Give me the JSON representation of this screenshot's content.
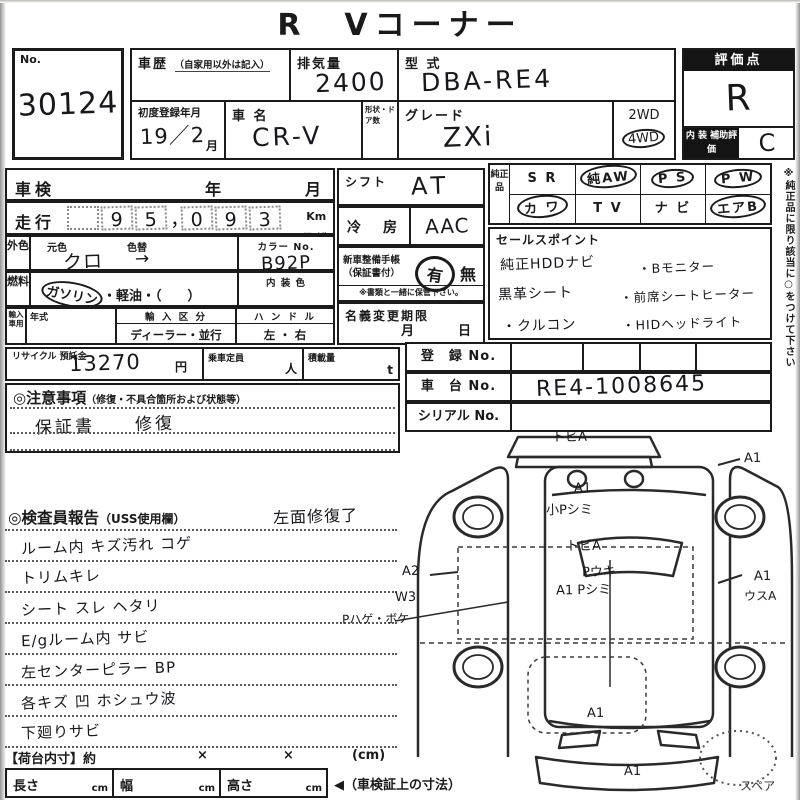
{
  "title": "R　Vコーナー",
  "lot_no": {
    "label": "No.",
    "value": "30124"
  },
  "history": {
    "label": "車歴",
    "note": "（自家用以外は記入）",
    "value": ""
  },
  "displacement": {
    "label": "排気量",
    "value": "2400"
  },
  "model_code": {
    "label": "型 式",
    "value": "DBA-RE4"
  },
  "first_registration": {
    "label": "初度登録年月",
    "value": "19／2",
    "suffix": "月"
  },
  "car_name": {
    "label": "車 名",
    "value": "CR-V"
  },
  "body_doors": {
    "label": "形状・ドア数",
    "value": ""
  },
  "grade": {
    "label": "グレード",
    "value": "ZXi"
  },
  "drivetrain": {
    "options": [
      "2WD",
      "4WD"
    ],
    "selected": "4WD"
  },
  "rating": {
    "header": "評価点",
    "value": "R",
    "interior_label": "内 装 補助評価",
    "interior_value": "C"
  },
  "shaken": {
    "label": "車検",
    "year_label": "年",
    "month_label": "月",
    "value": ""
  },
  "odometer": {
    "label": "走行",
    "digits": [
      "9",
      "5",
      "0",
      "9",
      "3"
    ],
    "comma": "，",
    "unit_km": "Km",
    "unit_mile": "マイル",
    "value": "95,093"
  },
  "exterior_color": {
    "label": "外色",
    "base_label": "元色",
    "base_value": "クロ",
    "change_label": "色替",
    "change_value": "→",
    "color_no_label": "カラー No.",
    "color_no_value": "B92P"
  },
  "fuel": {
    "label": "燃料",
    "gasoline": "ガソリン",
    "rest": "・軽油・（　　）",
    "selected": "ガソリン",
    "interior_color_label": "内 装 色",
    "interior_color_value": ""
  },
  "import_info": {
    "label": "輸入車用",
    "year_label": "年式",
    "division_label": "輸 入 区 分",
    "division_value": "ディーラー・並行",
    "handle_label": "ハ ン ド ル",
    "handle_value": "左 ・ 右"
  },
  "recycle": {
    "label": "リサイクル 預託金",
    "value": "13270",
    "unit": "円",
    "capacity_label": "乗車定員",
    "capacity_unit": "人",
    "load_label": "積載量",
    "load_unit": "t"
  },
  "cautions": {
    "header": "◎注意事項",
    "header_note": "（修復・不具合箇所および状態等）",
    "line1": "保証書　　修復"
  },
  "shift": {
    "label": "シフト",
    "value": "AT"
  },
  "aircon": {
    "label": "冷　房",
    "value": "AAC"
  },
  "service_book": {
    "label_line1": "新車整備手帳",
    "label_line2": "（保証書付）",
    "yes": "有",
    "no": "無",
    "selected": "有",
    "note": "※書類と一緒に保管下さい。"
  },
  "name_change": {
    "header": "名義変更期限",
    "month_label": "月",
    "day_label": "日"
  },
  "genuine": {
    "label": "純正品",
    "cells": [
      {
        "label": "S R",
        "circled": false
      },
      {
        "label": "純AW",
        "circled": true
      },
      {
        "label": "P S",
        "circled": true
      },
      {
        "label": "P W",
        "circled": true
      },
      {
        "label": "カ ワ",
        "circled": true
      },
      {
        "label": "T V",
        "circled": false
      },
      {
        "label": "ナ ビ",
        "circled": false
      },
      {
        "label": "エアB",
        "circled": true
      }
    ],
    "note_vertical": "※純正品に限り該当に○をつけて下さい"
  },
  "sales_points": {
    "header": "セールスポイント",
    "rows": [
      [
        "純正HDDナビ",
        "・Bモニター"
      ],
      [
        "黒革シート",
        "・前席シートヒーター"
      ],
      [
        "・クルコン",
        "・HIDヘッドライト"
      ]
    ]
  },
  "registration": {
    "reg_label": "登　録 No.",
    "reg_value": "",
    "chassis_label": "車　台 No.",
    "chassis_value": "RE4-1008645",
    "serial_label": "シリアル No.",
    "serial_value": ""
  },
  "inspector": {
    "header": "◎検査員報告",
    "header_note": "（USS使用欄）",
    "side_note": "左面修復了",
    "lines": [
      "ルーム内 キズ汚れ コゲ",
      "トリムキレ",
      "シート スレ ヘタリ",
      "E/gルーム内 サビ",
      "左センターピラー BP",
      "各キズ 凹 ホシュウ波",
      "下廻りサビ"
    ]
  },
  "cargo": {
    "header": "【荷台内寸】約",
    "x1": "×",
    "x2": "×",
    "unit": "(cm)",
    "length_label": "長さ",
    "width_label": "幅",
    "height_label": "高さ",
    "cm": "cm",
    "arrow_note": "◀（車検証上の寸法）"
  },
  "diagram": {
    "labels": {
      "top_tobi": "トビA",
      "roof_a1": "A1",
      "roof_shimi": "小Pシミ",
      "mid_tobi": "トビA",
      "p_uki": "Pウキ",
      "a1_pshimi": "A1 Pシミ",
      "left_a2": "A2",
      "left_w3": "W3",
      "left_hage": "Pハゲ・ボケ",
      "right_a1_top": "A1",
      "right_a1_low": "A1",
      "right_usu": "ウスA",
      "hood_a1": "A1",
      "bumper_a1": "A1",
      "spare": "スペア"
    }
  }
}
